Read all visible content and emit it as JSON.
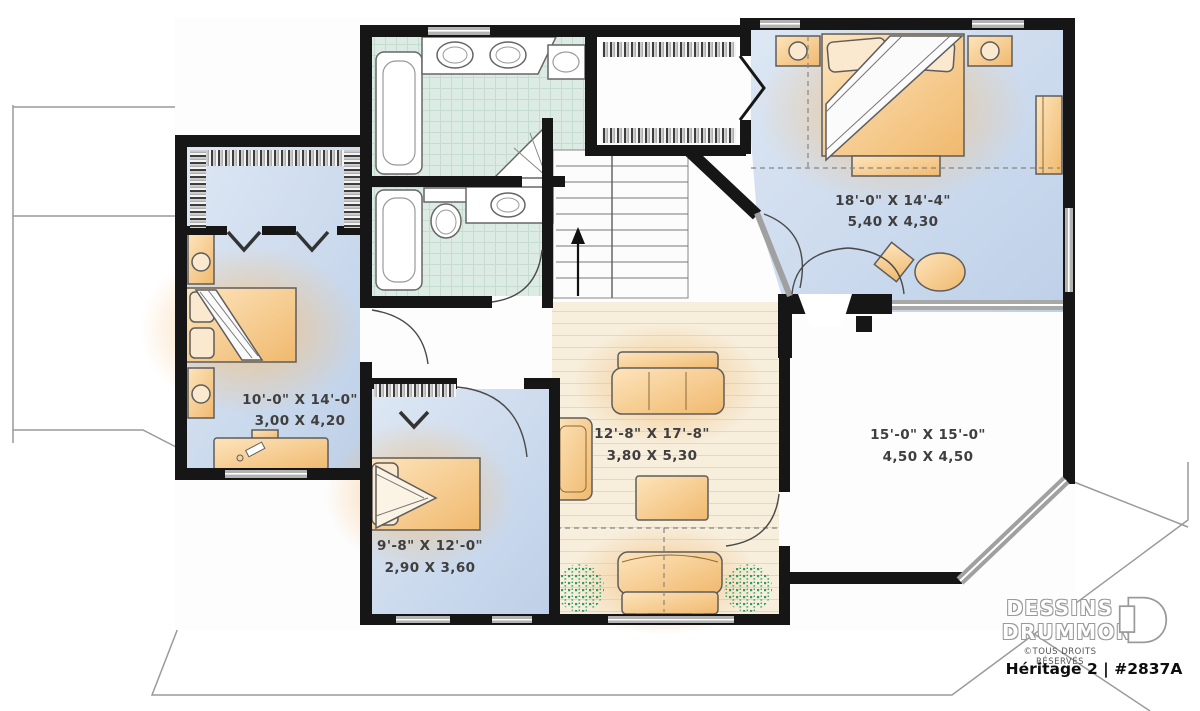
{
  "plan_type": "second-floor-plan",
  "rooms": {
    "master": {
      "imperial": "18'-0\" X 14'-4\"",
      "metric": "5,40 X 4,30"
    },
    "bedroom_left": {
      "imperial": "10'-0\" X 14'-0\"",
      "metric": "3,00 X 4,20"
    },
    "bedroom_bottom": {
      "imperial": "9'-8\" X 12'-0\"",
      "metric": "2,90 X 3,60"
    },
    "family_room": {
      "imperial": "12'-8\" X 17'-8\"",
      "metric": "3,80 X 5,30"
    },
    "open_area": {
      "imperial": "15'-0\" X 15'-0\"",
      "metric": "4,50 X 4,50"
    }
  },
  "stairs": {
    "direction": "up"
  },
  "branding": {
    "name_line1": "DESSINS",
    "name_line2": "DRUMMOND",
    "rights": "©TOUS DROITS RÉSERVÉS",
    "plan_title": "Héritage 2 | #2837A"
  },
  "colors": {
    "wall": "#161616",
    "bedroom_floor": "#c9d8ec",
    "bath_floor": "#dcebe4",
    "wood_floor": "#f7eedc",
    "furniture": "#f2c astray",
    "furniture_tan": "#f3cf9b",
    "plant_green": "#2e9e62",
    "window_gray": "#b3b3b3",
    "roofline_gray": "#9a9a9a"
  }
}
